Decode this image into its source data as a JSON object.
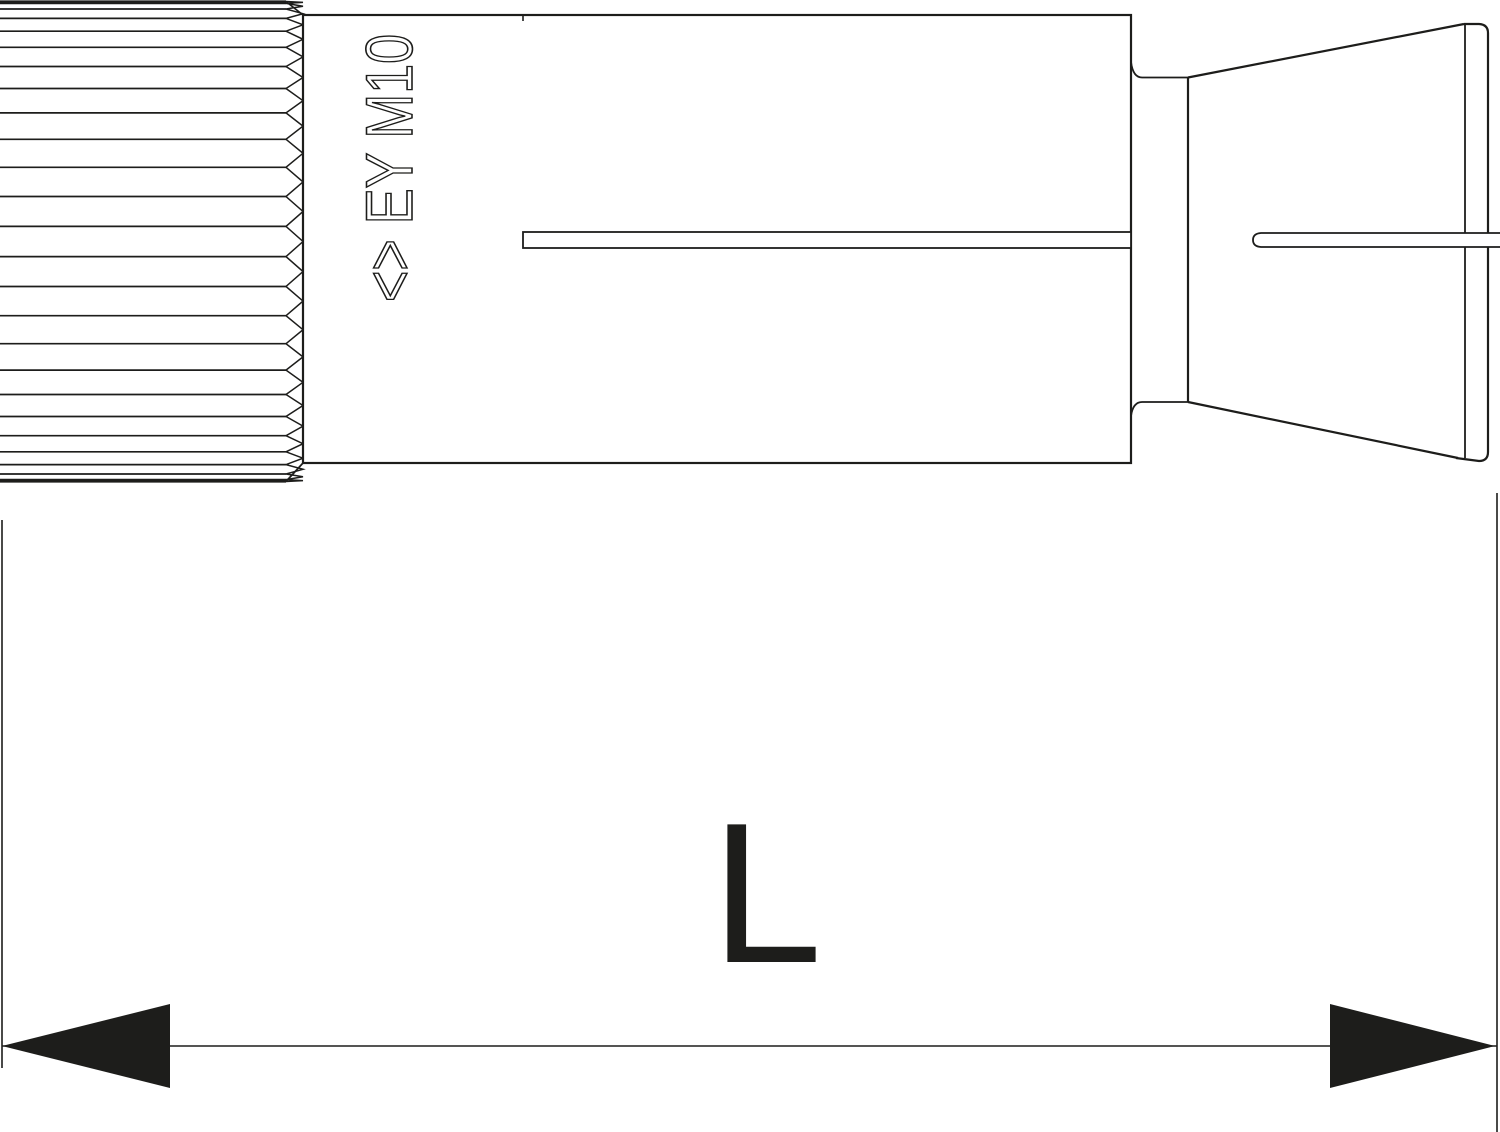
{
  "drawing": {
    "background_color": "#ffffff",
    "line_color": "#1d1d1b",
    "marking": {
      "symbol": "<>",
      "code": "EY M10",
      "full": "<> EY M10"
    },
    "dimension": {
      "label": "L"
    },
    "knurl": {
      "ridge_count": 26
    }
  }
}
